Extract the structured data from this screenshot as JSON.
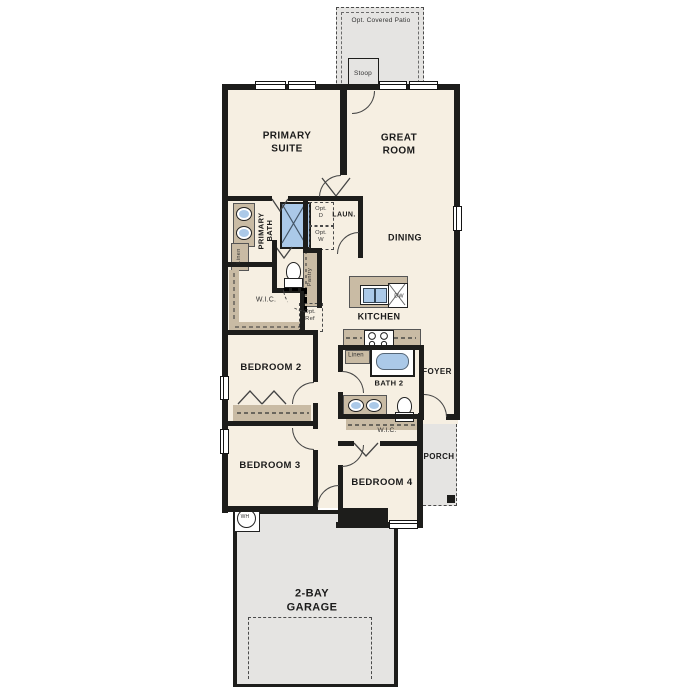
{
  "plan_title": "Single-story floor plan",
  "colors": {
    "floor": "#f6efe2",
    "wall": "#1d1d1b",
    "cabinet_tan": "#c9bba4",
    "outdoor_gray": "#e5e4e2",
    "fixture_blue": "#abc9e8"
  },
  "labels": {
    "patio": "Opt. Covered Patio",
    "stoop": "Stoop",
    "primary_suite": "PRIMARY\nSUITE",
    "great_room": "GREAT\nROOM",
    "primary_bath": "PRIMARY\nBATH",
    "opt_d": "Opt.\nD",
    "opt_w": "Opt.\nW",
    "laundry": "LAUN.",
    "linen_primary": "Linen",
    "pantry": "Pantry",
    "wic_primary": "W.I.C.",
    "opt_ref": "Opt.\nRef",
    "dining": "DINING",
    "kitchen": "KITCHEN",
    "dishwasher": "DW",
    "linen_bath2": "Linen",
    "bath2": "BATH 2",
    "foyer": "FOYER",
    "bedroom2": "BEDROOM 2",
    "bedroom3": "BEDROOM 3",
    "bedroom4": "BEDROOM 4",
    "wic_bedroom4": "W.I.C.",
    "porch": "PORCH",
    "water_heater": "WH",
    "garage": "2-BAY\nGARAGE"
  }
}
